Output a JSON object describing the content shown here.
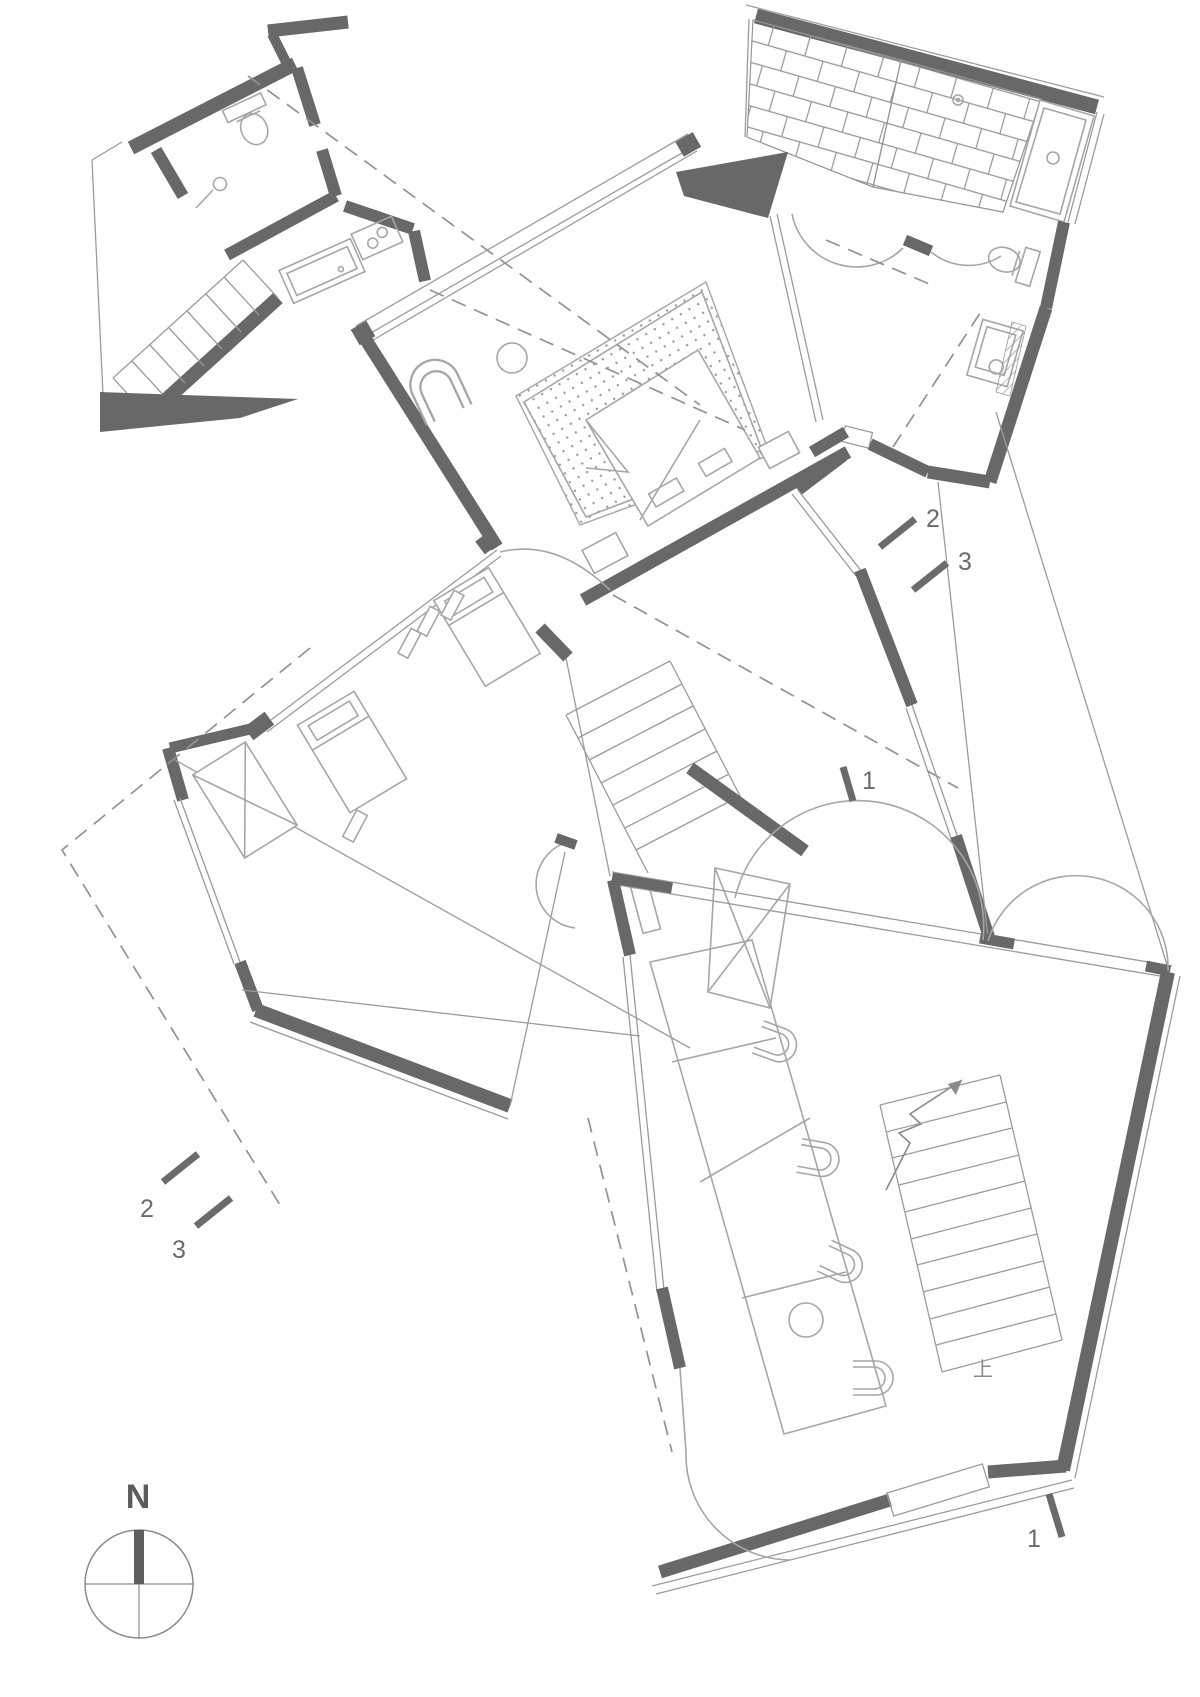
{
  "plan": {
    "type": "architectural-floor-plan",
    "colors": {
      "background": "#ffffff",
      "wall": "#686868",
      "line": "#9b9b9b",
      "furniture": "#a6a6a6",
      "text": "#6b6b6b"
    },
    "compass": {
      "label": "N"
    },
    "stairs": {
      "up_label": "上"
    },
    "section_markers": [
      {
        "id": "section-2-right",
        "label": "2"
      },
      {
        "id": "section-3-right",
        "label": "3"
      },
      {
        "id": "section-1-upper",
        "label": "1"
      },
      {
        "id": "section-2-left",
        "label": "2"
      },
      {
        "id": "section-3-left",
        "label": "3"
      },
      {
        "id": "section-1-bottom",
        "label": "1"
      }
    ]
  }
}
